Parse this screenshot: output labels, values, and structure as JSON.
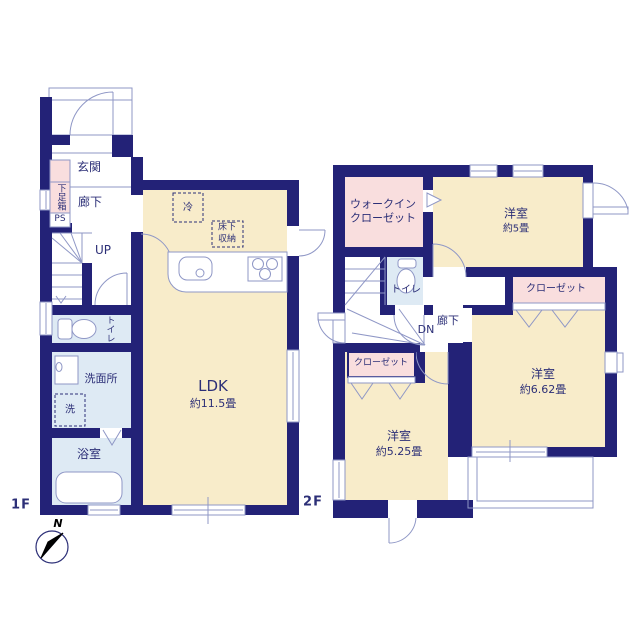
{
  "floor1": {
    "floor_label": "1F",
    "genkan": "玄関",
    "hallway": "廊下",
    "shoe_box": "下足箱",
    "pipe_space": "PS",
    "stairs": "UP",
    "toilet": "トイレ",
    "washroom": "洗面所",
    "washer": "洗",
    "bathroom": "浴室",
    "ldk_name": "LDK",
    "ldk_area": "約11.5畳",
    "fridge": "冷",
    "underfloor_storage_line1": "床下",
    "underfloor_storage_line2": "収納"
  },
  "floor2": {
    "floor_label": "2F",
    "walk_in_closet_line1": "ウォークイン",
    "walk_in_closet_line2": "クローゼット",
    "toilet": "トイレ",
    "stairs": "DN",
    "hallway": "廊下",
    "bedroom_5_name": "洋室",
    "bedroom_5_area": "約5畳",
    "closet_east": "クローゼット",
    "bedroom_662_name": "洋室",
    "bedroom_662_area": "約6.62畳",
    "closet_west": "クローゼット",
    "bedroom_525_name": "洋室",
    "bedroom_525_area": "約5.25畳"
  },
  "compass": {
    "north": "N"
  },
  "colors": {
    "wall": "#232277",
    "tatami_room": "#f8ecca",
    "wet_room": "#deeaf4",
    "closet": "#f9dede",
    "line": "#8f97c6",
    "text": "#2c2f77"
  }
}
